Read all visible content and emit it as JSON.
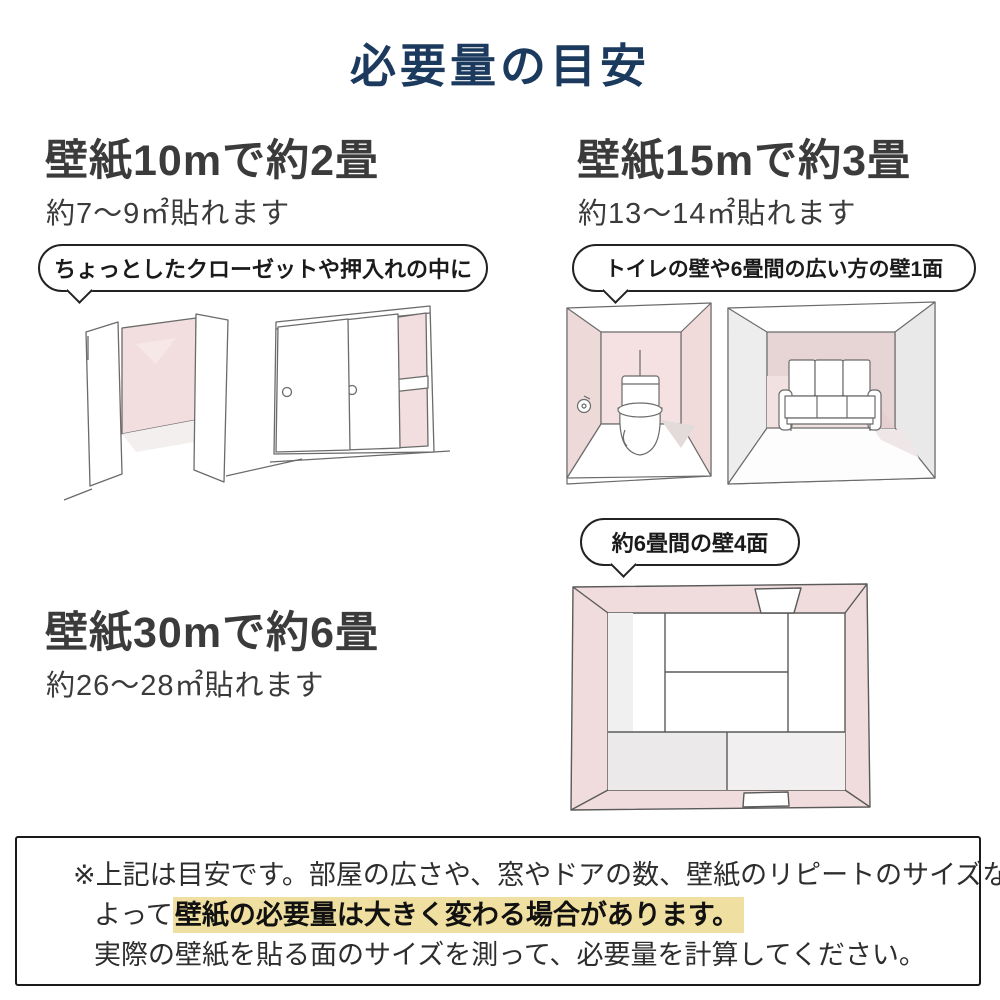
{
  "title": "必要量の目安",
  "sections": {
    "ten": {
      "heading": "壁紙10mで約2畳",
      "sub": "約7〜9㎡貼れます",
      "bubble": "ちょっとしたクローゼットや押入れの中に"
    },
    "fifteen": {
      "heading": "壁紙15mで約3畳",
      "sub": "約13〜14㎡貼れます",
      "bubble": "トイレの壁や6畳間の広い方の壁1面",
      "bubble_four_walls": "約6畳間の壁4面"
    },
    "thirty": {
      "heading": "壁紙30mで約6畳",
      "sub": "約26〜28㎡貼れます"
    }
  },
  "note": {
    "line1": "※上記は目安です。部屋の広さや、窓やドアの数、壁紙のリピートのサイズなどに",
    "line2_prefix": "よって",
    "line2_highlight": "壁紙の必要量は大きく変わる場合があります。",
    "line3": "実際の壁紙を貼る面のサイズを測って、必要量を計算してください。"
  },
  "icons": {
    "open_closet": "open-closet-sketch",
    "sliding_closet": "sliding-door-closet-sketch",
    "toilet_room": "toilet-room-sketch",
    "sofa_room": "six-tatami-room-sketch",
    "tatami_room": "six-tatami-room-top-view-sketch"
  },
  "colors": {
    "title_navy": "#1b3a5e",
    "heading_gray": "#3b3b3b",
    "wall_pink": "#f2dede",
    "wall_pink_dark": "#e6d3d3",
    "wall_gray": "#ececec",
    "sketch_outline": "#6b6b6b",
    "highlight_yellow": "#efdfa0",
    "note_border": "#1a1a1a"
  }
}
